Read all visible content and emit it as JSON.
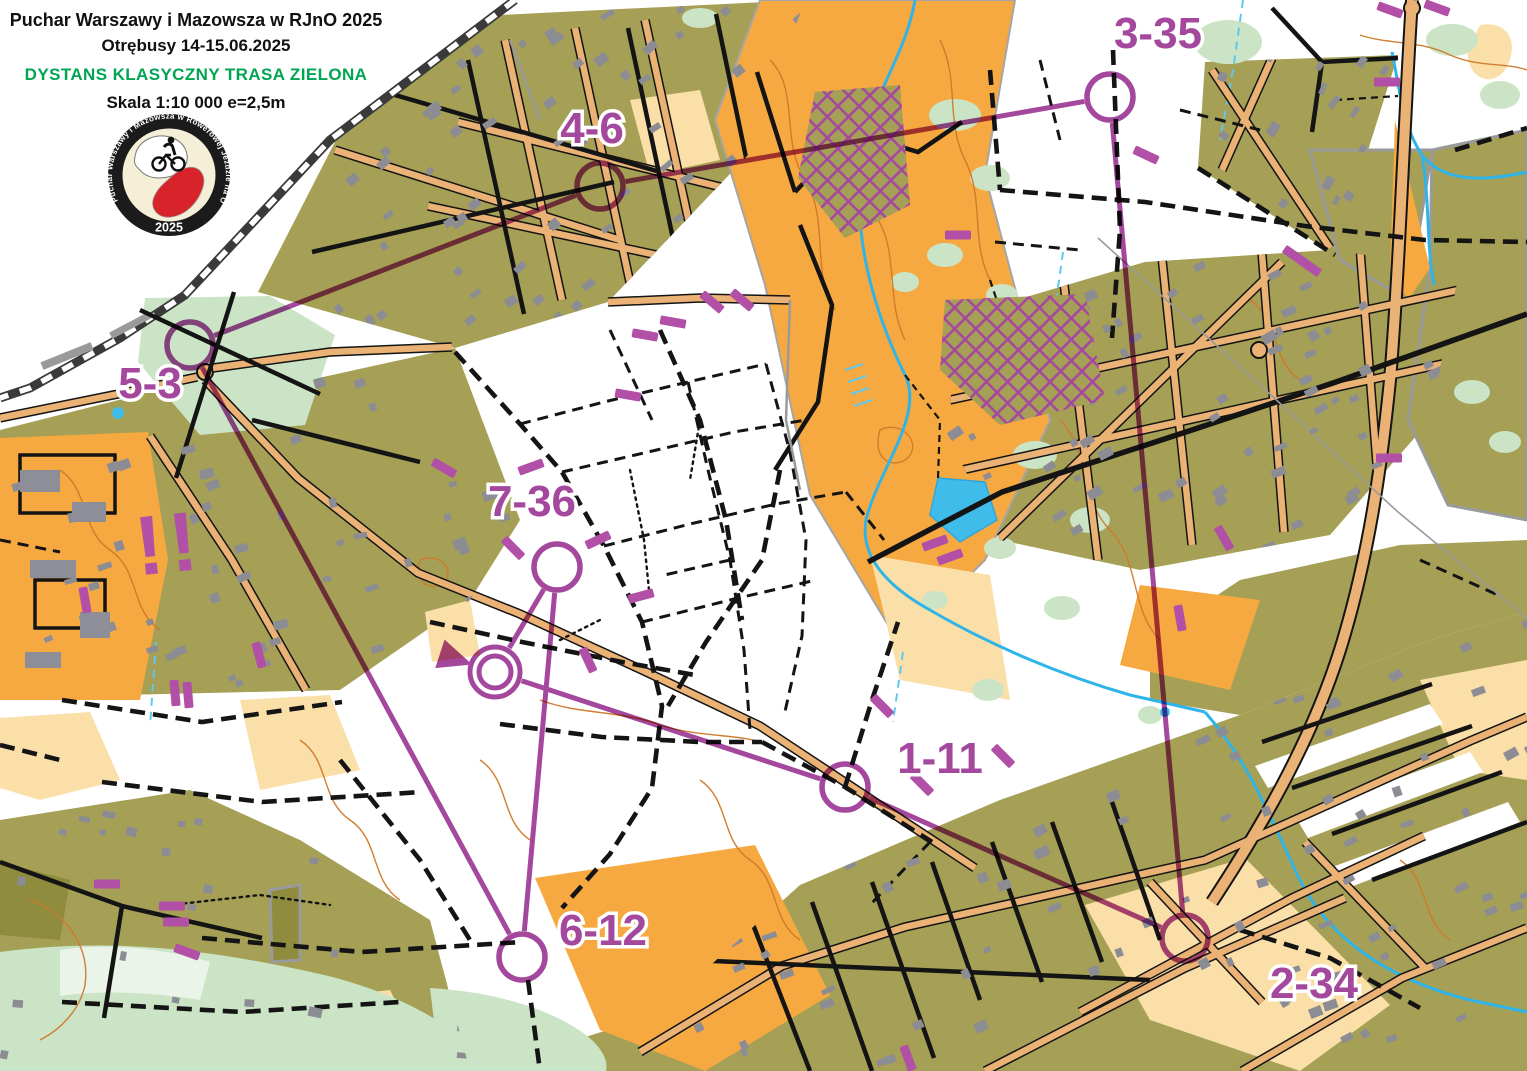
{
  "header": {
    "title": "Puchar Warszawy i Mazowsza w RJnO 2025",
    "subtitle": "Otrębusy 14-15.06.2025",
    "course_name": "DYSTANS KLASYCZNY TRASA ZIELONA",
    "scale": "Skala 1:10 000 e=2,5m",
    "course_name_color": "#00A551"
  },
  "logo": {
    "ring_text": "Puchar Warszawy i Mazowsza w Rowerowej Jeździe na Orientację",
    "year": "2025"
  },
  "map_colors": {
    "settlement_olive": "#A5A055",
    "open_orange": "#F7A941",
    "rough_pale": "#FBDFA8",
    "vegetation_green": "#CBE4C6",
    "water_blue": "#2FB4E9",
    "course_purple": "#A4489E",
    "mark_purple": "#B24FA6",
    "contour_brown": "#D0782A",
    "road_tan": "#EAB275"
  },
  "course": {
    "circle_radius": 23,
    "start": {
      "x": 495,
      "y": 672
    },
    "finish": {
      "x": 495,
      "y": 672
    },
    "controls": [
      {
        "code": "1-11",
        "x": 845,
        "y": 787,
        "lx": 940,
        "ly": 773
      },
      {
        "code": "2-34",
        "x": 1185,
        "y": 938,
        "lx": 1314,
        "ly": 998
      },
      {
        "code": "3-35",
        "x": 1110,
        "y": 97,
        "lx": 1158,
        "ly": 48
      },
      {
        "code": "4-6",
        "x": 600,
        "y": 186,
        "lx": 592,
        "ly": 143
      },
      {
        "code": "5-3",
        "x": 190,
        "y": 345,
        "lx": 150,
        "ly": 398
      },
      {
        "code": "6-12",
        "x": 522,
        "y": 957,
        "lx": 603,
        "ly": 945
      },
      {
        "code": "7-36",
        "x": 557,
        "y": 567,
        "lx": 532,
        "ly": 516
      }
    ]
  },
  "overlay": {
    "warning": {
      "text": "!!",
      "x": 172,
      "y": 572,
      "rotate": -6
    },
    "forbidden_marks": [
      {
        "x": 85,
        "y": 600,
        "a": 80
      },
      {
        "x": 175,
        "y": 693,
        "a": 85
      },
      {
        "x": 188,
        "y": 695,
        "a": 85
      },
      {
        "x": 259,
        "y": 655,
        "a": 75
      },
      {
        "x": 444,
        "y": 468,
        "a": 30
      },
      {
        "x": 531,
        "y": 467,
        "a": -20
      },
      {
        "x": 513,
        "y": 548,
        "a": 45
      },
      {
        "x": 598,
        "y": 540,
        "a": -25
      },
      {
        "x": 641,
        "y": 596,
        "a": -15
      },
      {
        "x": 588,
        "y": 660,
        "a": 65
      },
      {
        "x": 712,
        "y": 302,
        "a": 40
      },
      {
        "x": 742,
        "y": 300,
        "a": 40
      },
      {
        "x": 673,
        "y": 322,
        "a": 10
      },
      {
        "x": 645,
        "y": 335,
        "a": 10
      },
      {
        "x": 628,
        "y": 395,
        "a": 10
      },
      {
        "x": 935,
        "y": 543,
        "a": -20
      },
      {
        "x": 950,
        "y": 557,
        "a": -20
      },
      {
        "x": 958,
        "y": 235,
        "a": 0
      },
      {
        "x": 1146,
        "y": 155,
        "a": 25
      },
      {
        "x": 882,
        "y": 706,
        "a": 45
      },
      {
        "x": 922,
        "y": 784,
        "a": 45
      },
      {
        "x": 1003,
        "y": 756,
        "a": 45
      },
      {
        "x": 1224,
        "y": 538,
        "a": 60
      },
      {
        "x": 1295,
        "y": 256,
        "a": 35
      },
      {
        "x": 1309,
        "y": 266,
        "a": 35
      },
      {
        "x": 1389,
        "y": 458,
        "a": 0
      },
      {
        "x": 908,
        "y": 1058,
        "a": 70
      },
      {
        "x": 1180,
        "y": 618,
        "a": 80
      },
      {
        "x": 107,
        "y": 884,
        "a": 0
      },
      {
        "x": 172,
        "y": 906,
        "a": 0
      },
      {
        "x": 176,
        "y": 922,
        "a": 0
      },
      {
        "x": 187,
        "y": 952,
        "a": 20
      },
      {
        "x": 1390,
        "y": 10,
        "a": 20
      },
      {
        "x": 1437,
        "y": 8,
        "a": 20
      },
      {
        "x": 1387,
        "y": 82,
        "a": 0
      }
    ]
  }
}
